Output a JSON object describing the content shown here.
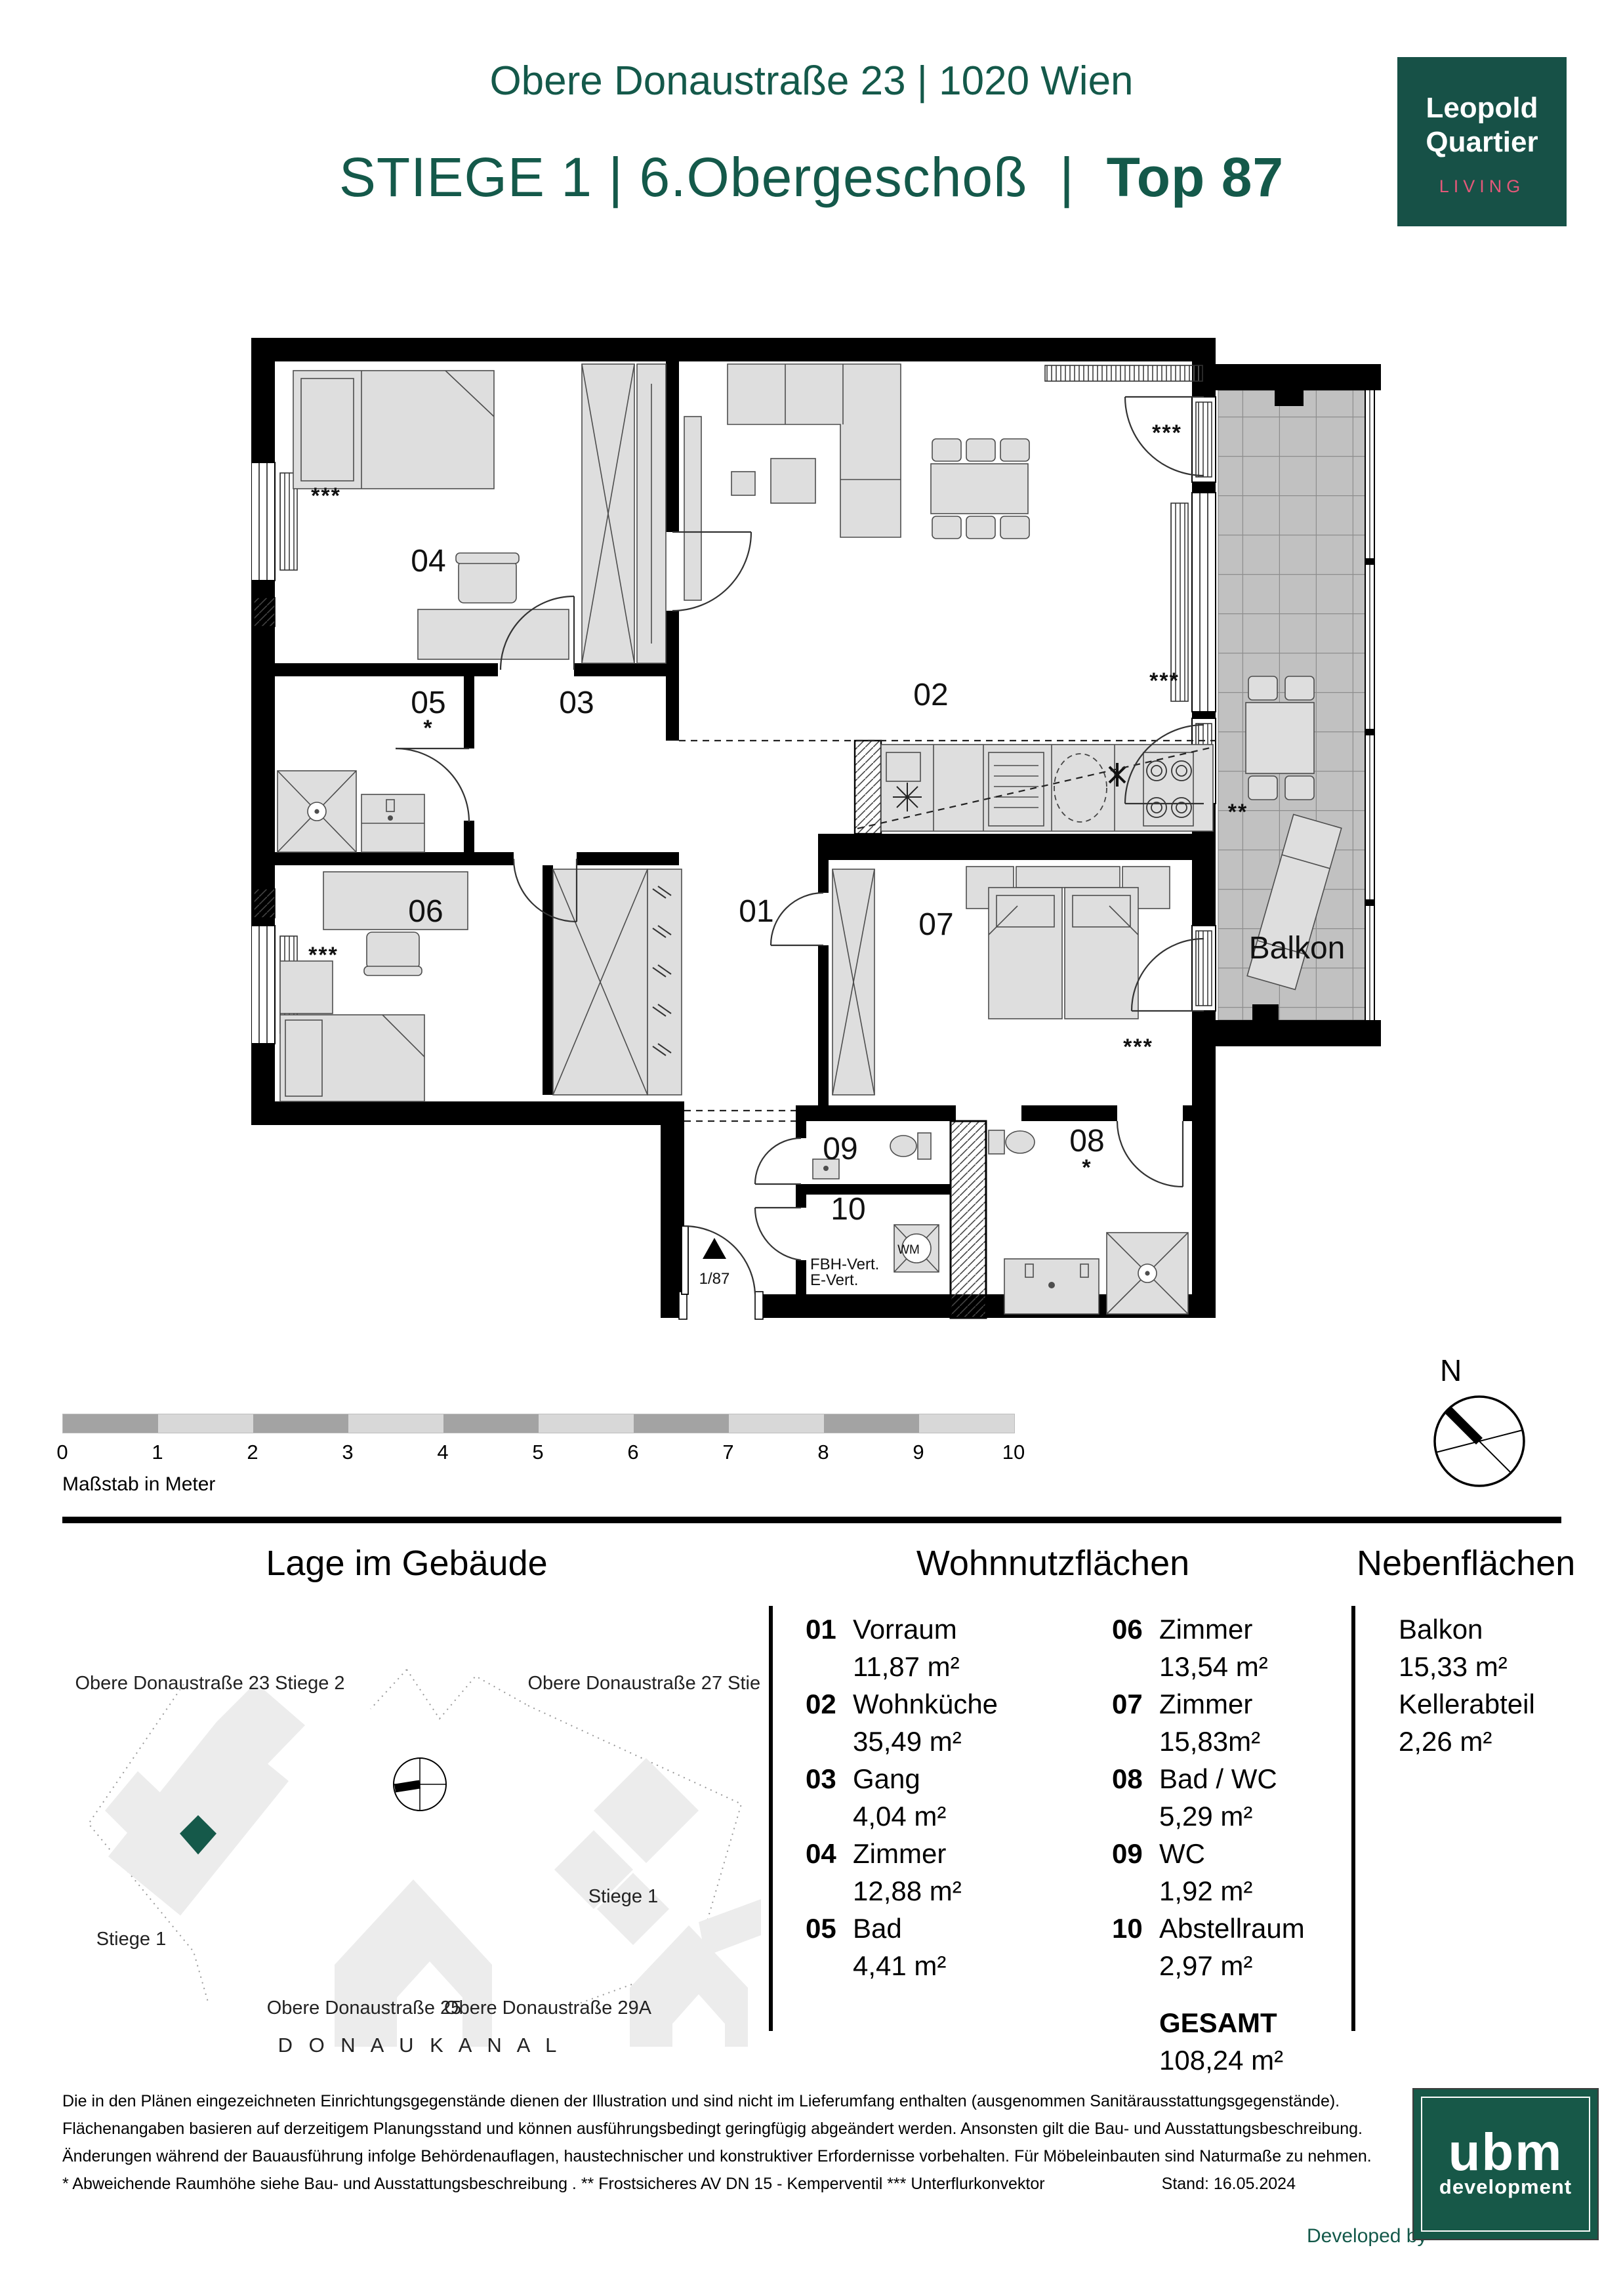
{
  "header": {
    "line1": "Obere Donaustraße 23 | 1020 Wien",
    "line2_stiege": "STIEGE 1",
    "pipe": "|",
    "line2_geschoss": "6.Obergeschoß",
    "line2_top": "Top 87"
  },
  "logo": {
    "line1": "Leopold",
    "line2": "Quartier",
    "subtitle": "LIVING",
    "bg_color": "#175147",
    "accent_color": "#e35879"
  },
  "plan": {
    "rooms": {
      "r01": "01",
      "r02": "02",
      "r03": "03",
      "r04": "04",
      "r05": "05",
      "r06": "06",
      "r07": "07",
      "r08": "08",
      "r09": "09",
      "r10": "10"
    },
    "balkon": "Balkon",
    "wm": "WM",
    "fbh": "FBH-Vert.",
    "evert": "E-Vert.",
    "entry_no": "1/87",
    "star1": "*",
    "star2": "**",
    "star3": "***"
  },
  "scale": {
    "ticks": [
      "0",
      "1",
      "2",
      "3",
      "4",
      "5",
      "6",
      "7",
      "8",
      "9",
      "10"
    ],
    "caption": "Maßstab in Meter"
  },
  "compass": {
    "north": "N"
  },
  "site": {
    "title": "Lage im Gebäude",
    "label_23": "Obere Donaustraße 23 Stiege 2",
    "label_27": "Obere Donaustraße 27 Stiege 2",
    "stiege1_right": "Stiege 1",
    "stiege1_left": "Stiege 1",
    "label_25": "Obere Donaustraße 25",
    "label_29a": "Obere Donaustraße 29A",
    "kanal": "D O N A U K A N A L",
    "highlight_color": "#15594a"
  },
  "areas": {
    "title": "Wohnnutzflächen",
    "items": [
      {
        "num": "01",
        "name": "Vorraum",
        "area": "11,87 m²"
      },
      {
        "num": "02",
        "name": "Wohnküche",
        "area": "35,49 m²"
      },
      {
        "num": "03",
        "name": "Gang",
        "area": "4,04 m²"
      },
      {
        "num": "04",
        "name": "Zimmer",
        "area": "12,88 m²"
      },
      {
        "num": "05",
        "name": "Bad",
        "area": "4,41 m²"
      },
      {
        "num": "06",
        "name": "Zimmer",
        "area": "13,54 m²"
      },
      {
        "num": "07",
        "name": "Zimmer",
        "area": "15,83m²"
      },
      {
        "num": "08",
        "name": "Bad / WC",
        "area": "5,29 m²"
      },
      {
        "num": "09",
        "name": "WC",
        "area": "1,92 m²"
      },
      {
        "num": "10",
        "name": "Abstellraum",
        "area": "2,97 m²"
      }
    ],
    "total_label": "GESAMT",
    "total_value": "108,24 m²"
  },
  "neben": {
    "title": "Nebenflächen",
    "items": [
      {
        "name": "Balkon",
        "area": "15,33 m²"
      },
      {
        "name": "Kellerabteil",
        "area": "2,26 m²"
      }
    ]
  },
  "footer": {
    "line1": "Die in den Plänen eingezeichneten Einrichtungsgegenstände dienen der Illustration und sind nicht im Lieferumfang enthalten (ausgenommen Sanitärausstattungsgegenstände).",
    "line2": "Flächenangaben basieren auf derzeitigem Planungsstand und können ausführungsbedingt geringfügig abgeändert werden. Ansonsten gilt die Bau- und Ausstattungsbeschreibung.",
    "line3": "Änderungen während der Bauausführung infolge Behördenauflagen, haustechnischer und konstruktiver Erfordernisse vorbehalten. Für Möbeleinbauten sind Naturmaße zu nehmen.",
    "line4": "* Abweichende Raumhöhe siehe Bau- und Ausstattungsbeschreibung . ** Frostsicheres AV DN 15 - Kemperventil  *** Unterflurkonvektor",
    "stand": "Stand: 16.05.2024",
    "developed_by": "Developed by"
  },
  "ubm": {
    "name": "ubm",
    "sub": "development",
    "bg_color": "#175848"
  }
}
